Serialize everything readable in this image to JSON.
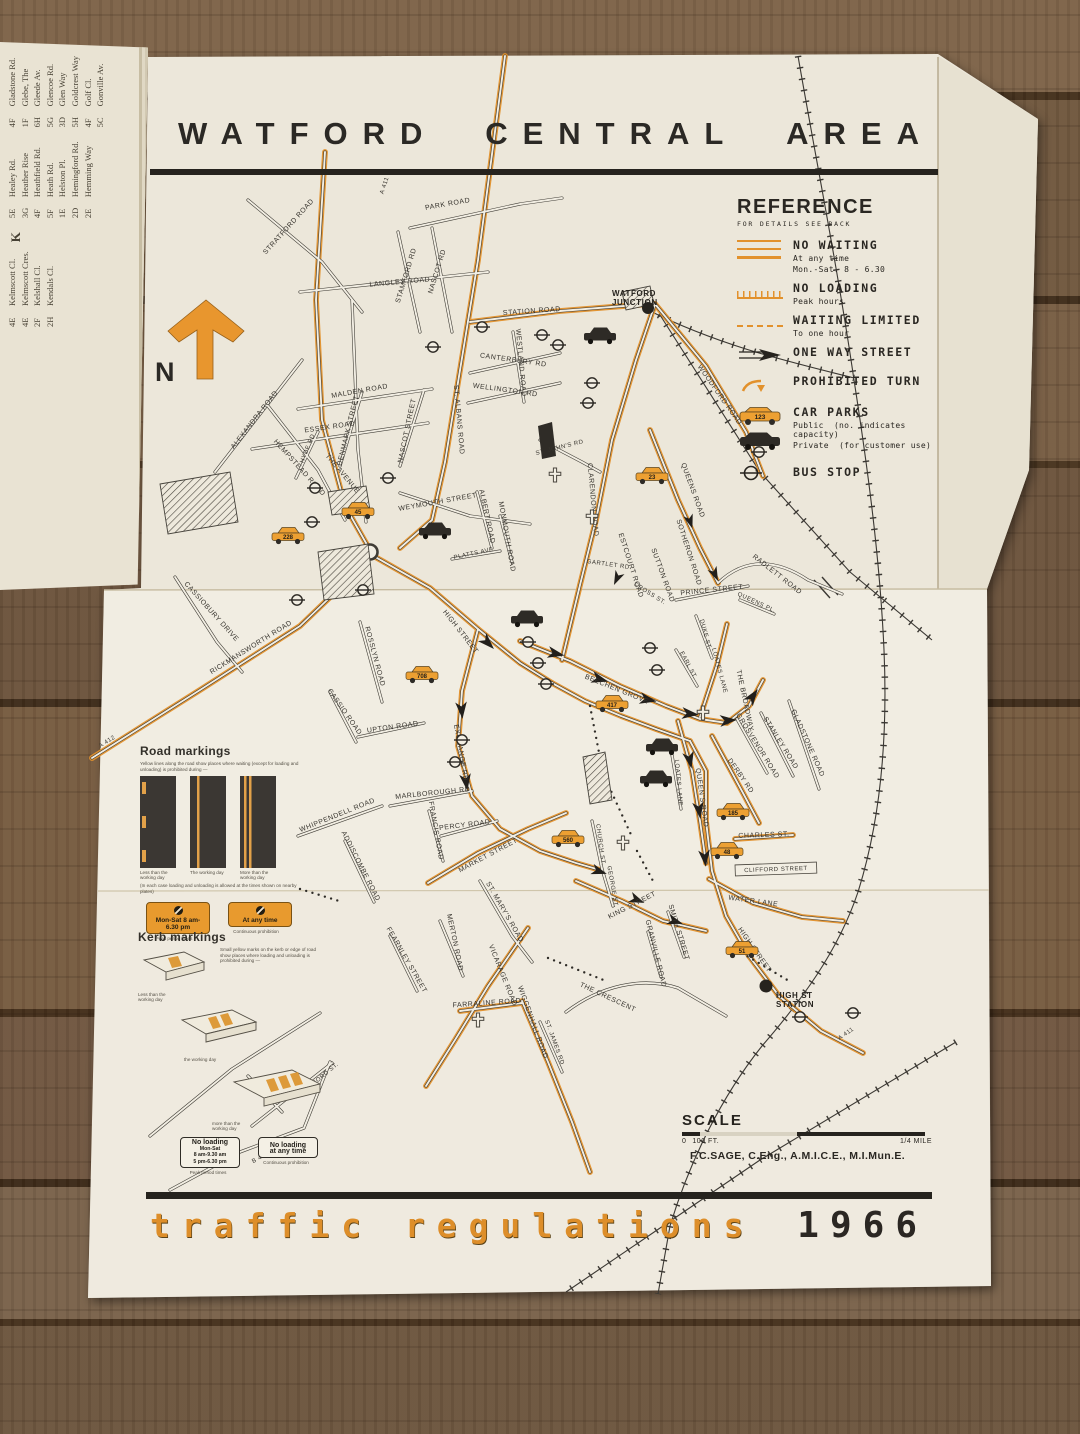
{
  "photo": {
    "surface": "wood-table"
  },
  "sheet": {
    "title": "WATFORD CENTRAL AREA",
    "footer_title": "traffic regulations",
    "footer_year": "1966",
    "credit": "F.C.SAGE, C.Eng., A.M.I.C.E., M.I.Mun.E.",
    "north_label": "N"
  },
  "reference": {
    "title": "REFERENCE",
    "subtitle": "FOR DETAILS SEE BACK",
    "no_waiting": {
      "label": "NO WAITING",
      "line1": "At any time",
      "line2": "Mon.-Sat. 8 - 6.30"
    },
    "no_loading": {
      "label": "NO LOADING",
      "line1": "Peak hours"
    },
    "waiting_limited": {
      "label": "WAITING LIMITED",
      "line1": "To one hour"
    },
    "one_way": {
      "label": "ONE WAY STREET"
    },
    "prohibited_turn": {
      "label": "PROHIBITED TURN"
    },
    "car_parks": {
      "label": "CAR PARKS",
      "public": "Public",
      "public_note": "(no. indicates capacity)",
      "private": "Private",
      "private_note": "(for customer use)",
      "sample_capacity": "123"
    },
    "bus_stop": {
      "label": "BUS STOP"
    }
  },
  "road_markings": {
    "title": "Road markings",
    "intro": "Yellow lines along the road show places where waiting (except for loading and unloading) is prohibited during —",
    "captions": [
      "Less than the working day",
      "The working day",
      "More than the working day"
    ],
    "note": "(In each case loading and unloading is allowed at the times shown on nearby plates)",
    "signs": [
      {
        "text": "Mon-Sat 8 am-6.30 pm",
        "caption": "Peak period times"
      },
      {
        "text": "At any time",
        "caption": "Continuous prohibition"
      }
    ]
  },
  "kerb_markings": {
    "title": "Kerb markings",
    "intro": "Small yellow marks on the kerb or edge of road show places where loading and unloading is prohibited during —",
    "captions": [
      "Less than the working day",
      "the working day",
      "more than the working day"
    ],
    "signs": [
      {
        "lines": [
          "No loading",
          "Mon-Sat",
          "8 am-9.30 am",
          "5 pm-6.30 pm"
        ],
        "caption": "Peak period times"
      },
      {
        "lines": [
          "No loading",
          "at any time"
        ],
        "caption": "Continuous prohibition"
      }
    ]
  },
  "scale": {
    "label": "SCALE",
    "zero": "0",
    "hundred": "100 FT.",
    "quarter": "1/4 MILE"
  },
  "index_pages": {
    "groups": [
      {
        "header": "",
        "entries": [
          [
            "Gladstone Rd.",
            "4F"
          ],
          [
            "Glebe, The",
            "1F"
          ],
          [
            "Gleede Av.",
            "6H"
          ],
          [
            "Glencoe Rd.",
            "5G"
          ],
          [
            "Glen Way",
            "3D"
          ],
          [
            "Goldcrest Way",
            "5H"
          ],
          [
            "Golf Cl.",
            "4F"
          ],
          [
            "Gonville Av.",
            "5C"
          ]
        ]
      },
      {
        "header": "",
        "entries": [
          [
            "Healey Rd.",
            "5E"
          ],
          [
            "Heather Rise",
            "3G"
          ],
          [
            "Heathfield Rd.",
            "4F"
          ],
          [
            "Heath Rd.",
            "5F"
          ],
          [
            "Helston Pl.",
            "1E"
          ],
          [
            "Hemingford Rd.",
            "2D"
          ],
          [
            "Hemming Way",
            "2E"
          ]
        ]
      },
      {
        "header": "K",
        "entries": [
          [
            "Kelmscott Cl.",
            "4E"
          ],
          [
            "Kelmscott Cres.",
            "4E"
          ],
          [
            "Kelshall Cl.",
            "2F"
          ],
          [
            "Kendals Cl.",
            "2H"
          ]
        ]
      }
    ]
  },
  "map": {
    "stations": [
      {
        "lines": [
          "WATFORD",
          "JUNCTION"
        ],
        "x": 612,
        "y": 296
      },
      {
        "lines": [
          "HIGH ST",
          "STATION"
        ],
        "x": 776,
        "y": 998
      }
    ],
    "street_labels": [
      [
        "PARK ROAD",
        448,
        206,
        -10
      ],
      [
        "STRATFORD ROAD",
        290,
        228,
        -48
      ],
      [
        "STAMFORD RD",
        408,
        276,
        -73
      ],
      [
        "NASCOT RD",
        439,
        272,
        -73
      ],
      [
        "LANGLEY ROAD",
        400,
        284,
        -5
      ],
      [
        "STATION ROAD",
        532,
        313,
        -4
      ],
      [
        "CANTERBURY RD",
        513,
        362,
        8
      ],
      [
        "WELLINGTON RD",
        505,
        392,
        8
      ],
      [
        "WESTLAND ROAD",
        519,
        363,
        85
      ],
      [
        "ALEXANDRA ROAD",
        256,
        421,
        -52
      ],
      [
        "DENMARK STREET",
        350,
        431,
        -76
      ],
      [
        "NASCOT STREET",
        409,
        431,
        -78
      ],
      [
        "MALDEN ROAD",
        360,
        393,
        -10
      ],
      [
        "ESSEX ROAD",
        330,
        429,
        -8
      ],
      [
        "ST. ALBANS ROAD",
        457,
        420,
        85
      ],
      [
        "A 411",
        386,
        186,
        -72,
        6
      ],
      [
        "WOODFORD ROAD",
        718,
        396,
        55
      ],
      [
        "ST. JOHN'S RD",
        560,
        449,
        -14,
        6
      ],
      [
        "CLARENDON ROAD",
        591,
        500,
        85
      ],
      [
        "QUEENS ROAD",
        691,
        491,
        70
      ],
      [
        "RADLETT ROAD",
        776,
        576,
        38
      ],
      [
        "SOTHERON ROAD",
        687,
        553,
        72
      ],
      [
        "SUTTON ROAD",
        661,
        576,
        70
      ],
      [
        "ESTCOURT ROAD",
        629,
        566,
        72
      ],
      [
        "GARTLET RD",
        608,
        566,
        8,
        6
      ],
      [
        "CROSS ST.",
        649,
        595,
        32,
        6
      ],
      [
        "PRINCE STREET",
        712,
        592,
        -6
      ],
      [
        "DUKE ST.",
        704,
        635,
        75,
        6
      ],
      [
        "EARL ST.",
        687,
        666,
        62,
        6
      ],
      [
        "LOATES LANE",
        718,
        671,
        75,
        6
      ],
      [
        "QUEENS PL.",
        756,
        604,
        25,
        6
      ],
      [
        "THE BROADWAY",
        743,
        701,
        78
      ],
      [
        "BEECHEN GROVE",
        616,
        691,
        22
      ],
      [
        "EXCHANGE RD",
        459,
        753,
        80
      ],
      [
        "HIGH STREET",
        459,
        633,
        52
      ],
      [
        "HIGH STREET",
        753,
        951,
        55
      ],
      [
        "RICKMANSWORTH ROAD",
        252,
        649,
        -32
      ],
      [
        "CASSIOBURY DRIVE",
        210,
        613,
        48
      ],
      [
        "A 412",
        108,
        743,
        -33,
        6
      ],
      [
        "HEMPSTEAD ROAD",
        298,
        469,
        48
      ],
      [
        "THE AVENUE",
        341,
        475,
        50
      ],
      [
        "HYDE RD",
        309,
        449,
        -68,
        6
      ],
      [
        "WEYMOUTH STREET",
        438,
        504,
        -10
      ],
      [
        "ALBERT ROAD",
        485,
        517,
        78
      ],
      [
        "MONMOUTH ROAD",
        505,
        537,
        80
      ],
      [
        "PLATTS AVE",
        474,
        555,
        -12,
        6
      ],
      [
        "ROSSLYN ROAD",
        373,
        657,
        75
      ],
      [
        "CASSIO ROAD",
        343,
        713,
        55
      ],
      [
        "UPTON ROAD",
        393,
        729,
        -8
      ],
      [
        "MARLBOROUGH RD",
        433,
        795,
        -6
      ],
      [
        "FRANCIS ROAD",
        434,
        831,
        80
      ],
      [
        "PERCY ROAD",
        465,
        827,
        -7
      ],
      [
        "WHIPPENDELL ROAD",
        338,
        817,
        -22
      ],
      [
        "ADDISCOMBE ROAD",
        359,
        867,
        63
      ],
      [
        "MARKET STREET",
        489,
        857,
        -28
      ],
      [
        "ST. MARY'S ROAD",
        503,
        913,
        60
      ],
      [
        "MERTON ROAD",
        453,
        943,
        78
      ],
      [
        "VICARAGE ROAD",
        501,
        976,
        68
      ],
      [
        "FEARNLEY STREET",
        405,
        961,
        60
      ],
      [
        "FARRALINE ROAD",
        487,
        1005,
        -4
      ],
      [
        "WIGGENHALL ROAD",
        531,
        1023,
        70
      ],
      [
        "THE CRESCENT",
        607,
        999,
        25
      ],
      [
        "ST. JAMES RD",
        553,
        1043,
        70,
        6
      ],
      [
        "OXFORD ST.",
        323,
        1078,
        -40,
        6
      ],
      [
        "B 4504",
        263,
        1158,
        -28,
        6
      ],
      [
        "CHURCH ST.",
        599,
        845,
        82,
        6
      ],
      [
        "GEORGE ST.",
        611,
        887,
        80,
        6
      ],
      [
        "KING STREET",
        633,
        907,
        -27
      ],
      [
        "SMITH STREET",
        677,
        933,
        73
      ],
      [
        "GRANVILLE ROAD",
        654,
        954,
        76
      ],
      [
        "QUEEN'S ROAD",
        700,
        798,
        82
      ],
      [
        "LOATES LANE",
        677,
        783,
        85,
        6
      ],
      [
        "DERBY RD",
        739,
        777,
        55
      ],
      [
        "GROSVENOR ROAD",
        756,
        747,
        58
      ],
      [
        "STANLEY ROAD",
        779,
        744,
        58
      ],
      [
        "GLADSTONE ROAD",
        806,
        744,
        66
      ],
      [
        "CHARLES ST.",
        764,
        837,
        -2
      ],
      [
        "CLIFFORD STREET",
        776,
        871,
        -2,
        6,
        1
      ],
      [
        "WATER LANE",
        753,
        903,
        8
      ],
      [
        "A 411",
        847,
        1035,
        -35,
        6
      ]
    ],
    "car_parks_public": [
      {
        "n": "45",
        "x": 358,
        "y": 512
      },
      {
        "n": "228",
        "x": 288,
        "y": 537
      },
      {
        "n": "708",
        "x": 422,
        "y": 676
      },
      {
        "n": "23",
        "x": 652,
        "y": 477
      },
      {
        "n": "417",
        "x": 612,
        "y": 705
      },
      {
        "n": "185",
        "x": 733,
        "y": 813
      },
      {
        "n": "48",
        "x": 727,
        "y": 852
      },
      {
        "n": "560",
        "x": 568,
        "y": 840
      },
      {
        "n": "51",
        "x": 742,
        "y": 951
      }
    ],
    "car_parks_private": [
      [
        600,
        337
      ],
      [
        435,
        532
      ],
      [
        527,
        620
      ],
      [
        662,
        748
      ],
      [
        656,
        780
      ]
    ],
    "bus_stops": [
      [
        482,
        327
      ],
      [
        433,
        347
      ],
      [
        542,
        335
      ],
      [
        558,
        345
      ],
      [
        592,
        383
      ],
      [
        588,
        403
      ],
      [
        388,
        478
      ],
      [
        315,
        488
      ],
      [
        312,
        522
      ],
      [
        297,
        600
      ],
      [
        363,
        590
      ],
      [
        759,
        452
      ],
      [
        650,
        648
      ],
      [
        657,
        670
      ],
      [
        528,
        642
      ],
      [
        538,
        663
      ],
      [
        546,
        684
      ],
      [
        462,
        740
      ],
      [
        455,
        762
      ],
      [
        800,
        1017
      ],
      [
        853,
        1013
      ]
    ],
    "churches": [
      [
        555,
        475
      ],
      [
        592,
        517
      ],
      [
        703,
        713
      ],
      [
        623,
        843
      ],
      [
        478,
        1020
      ]
    ]
  }
}
